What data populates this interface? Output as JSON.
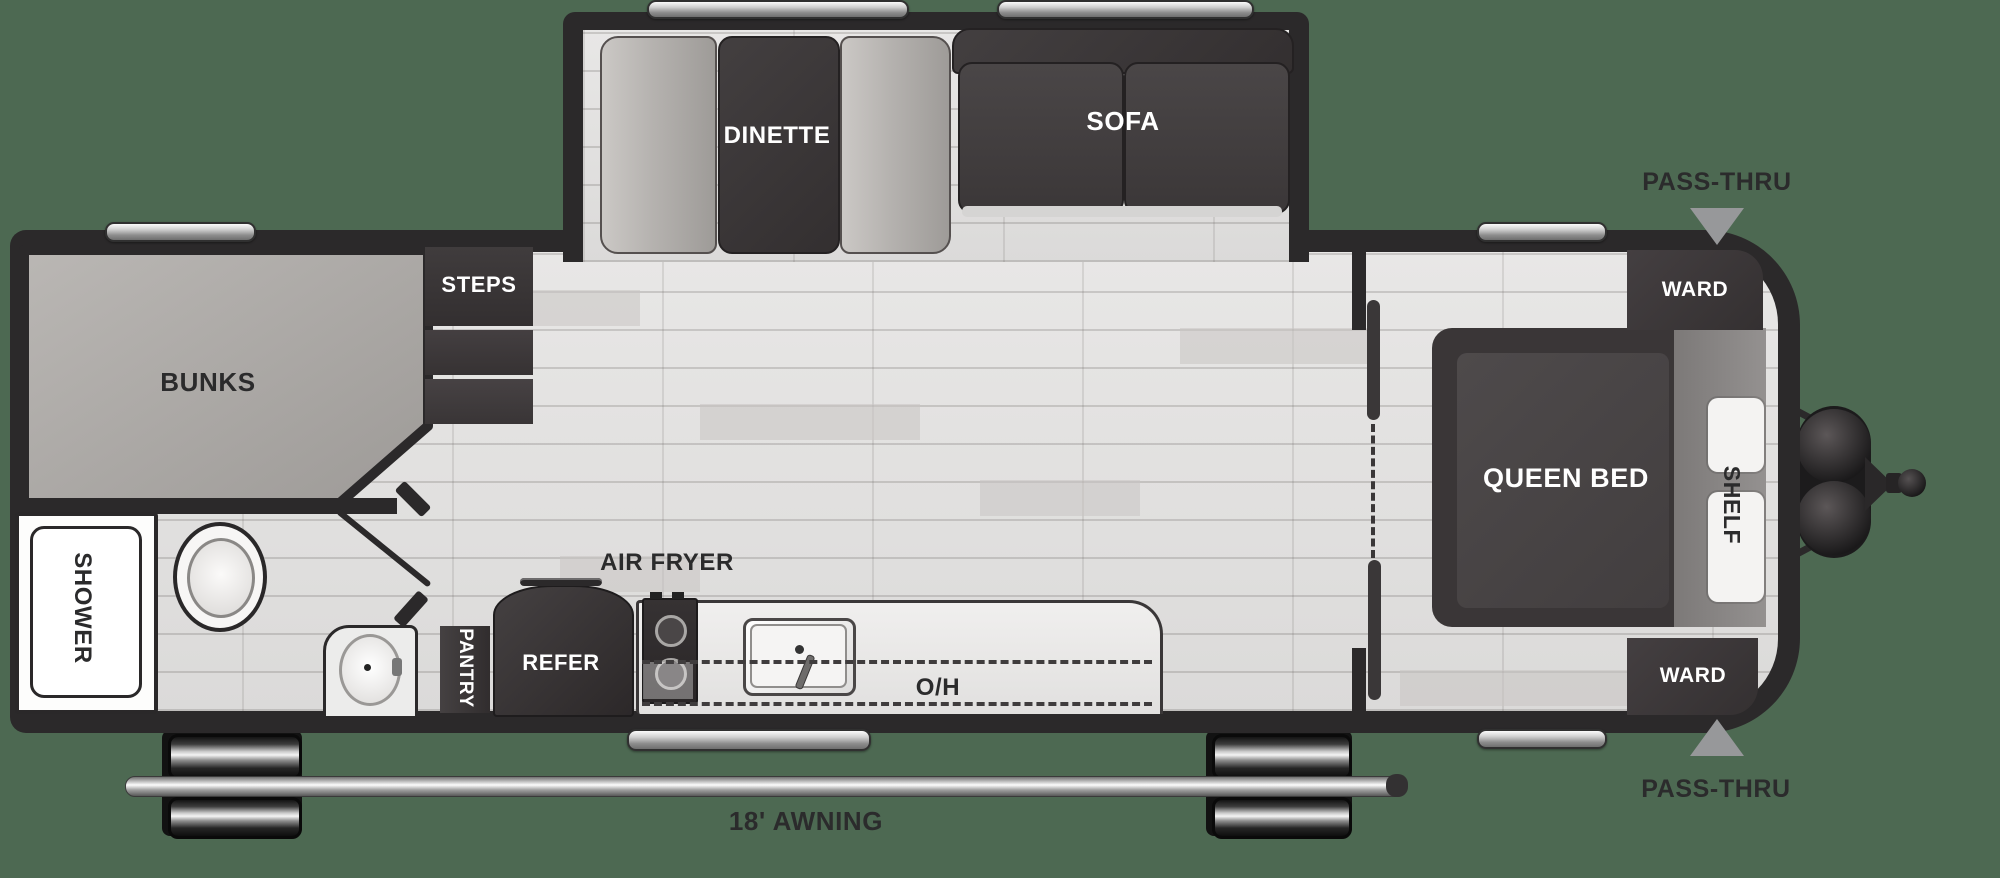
{
  "title": "Travel trailer floor plan",
  "background_color": "#4d6952",
  "colors": {
    "wall": "#2b292a",
    "floor": "#e4e3e2",
    "furniture_dark": "#3b3738",
    "bench_light": "#b5b2af",
    "window_silver": "#cfcfcf",
    "triangle_gray": "#97989a",
    "label_dark": "#2b2b2c",
    "label_white": "#ffffff"
  },
  "areas": {
    "bunks": {
      "label": "BUNKS"
    },
    "steps": {
      "label": "STEPS"
    },
    "slide_out": {
      "dinette": {
        "label": "DINETTE"
      },
      "sofa": {
        "label": "SOFA"
      }
    },
    "bathroom": {
      "shower": {
        "label": "SHOWER"
      }
    },
    "kitchen": {
      "pantry": {
        "label": "PANTRY"
      },
      "refrigerator": {
        "label": "REFER"
      },
      "air_fryer": {
        "label": "AIR FRYER"
      },
      "overhead_cabinet": {
        "label": "O/H"
      }
    },
    "bedroom": {
      "queen_bed": {
        "label": "QUEEN BED"
      },
      "shelf": {
        "label": "SHELF"
      },
      "ward_top": {
        "label": "WARD"
      },
      "ward_bottom": {
        "label": "WARD"
      }
    },
    "exterior": {
      "pass_thru_top": {
        "label": "PASS-THRU"
      },
      "pass_thru_bottom": {
        "label": "PASS-THRU"
      },
      "awning": {
        "label": "18' AWNING"
      }
    }
  }
}
